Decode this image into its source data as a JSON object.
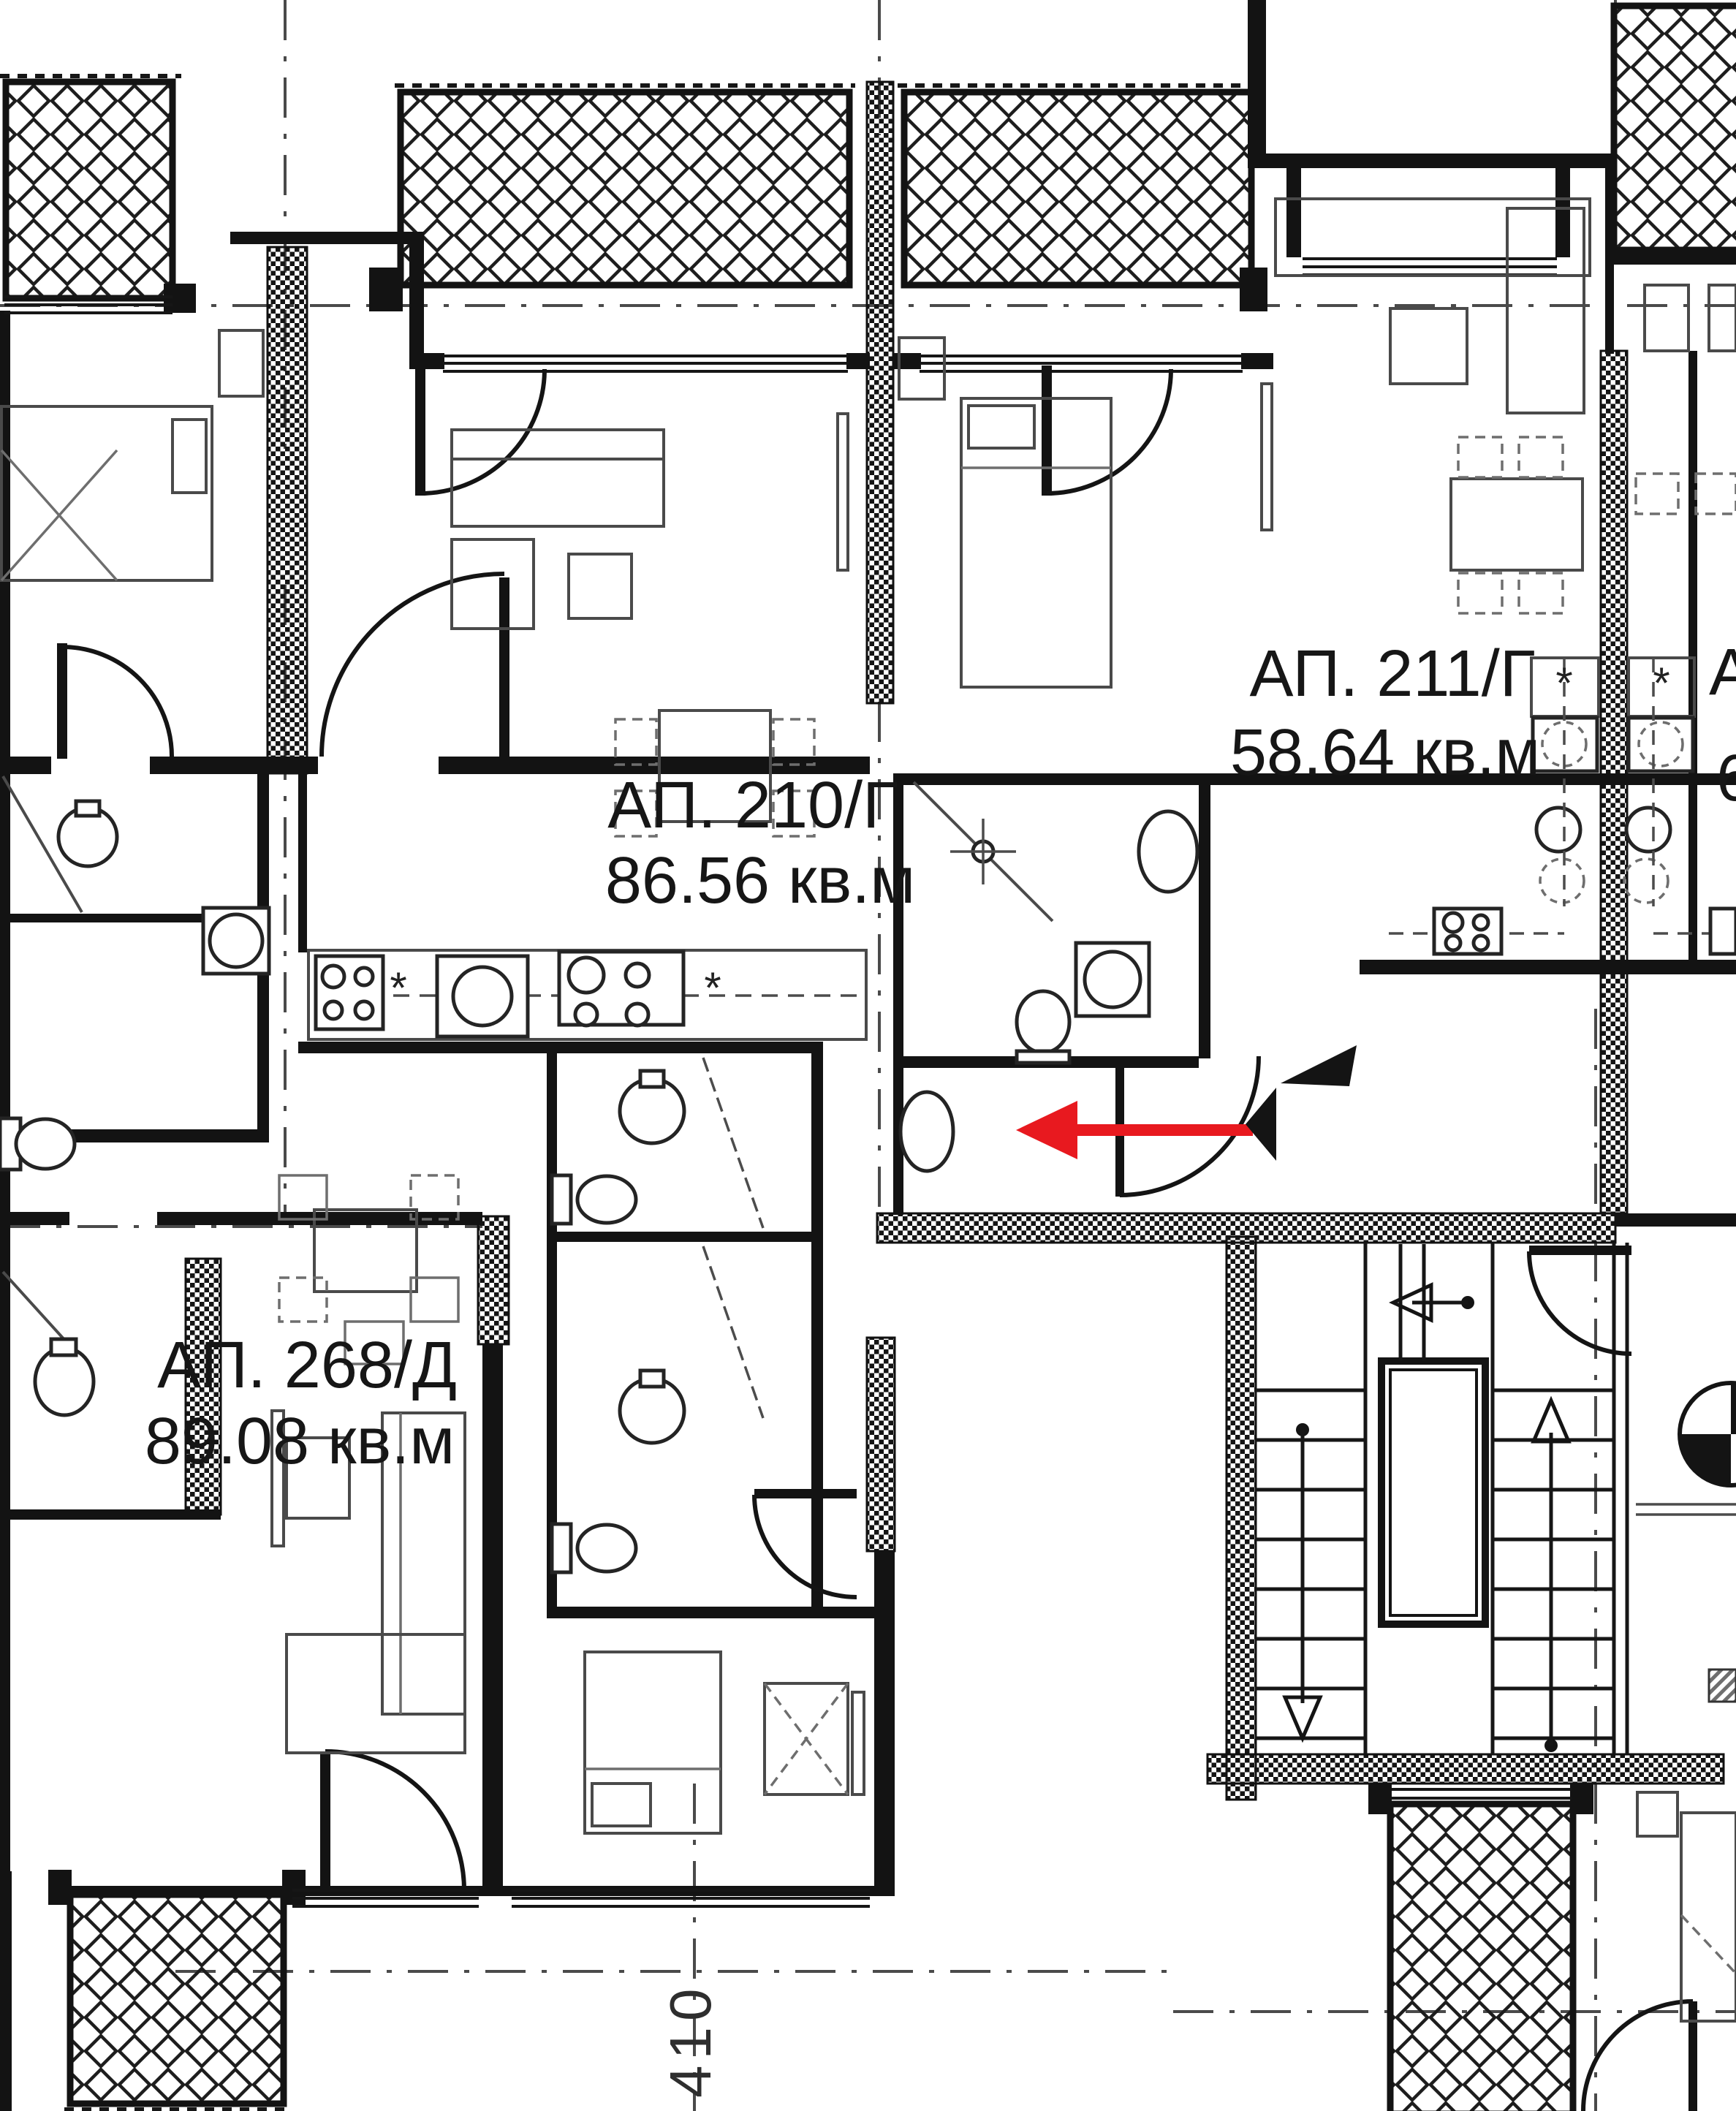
{
  "plan": {
    "apartments": [
      {
        "name": "АП. 210/Г",
        "area": "86.56 кв.м"
      },
      {
        "name": "АП. 211/Г",
        "area": "58.64 кв.м"
      },
      {
        "name": "АП. 268/Д",
        "area": "89.08 кв.м"
      }
    ],
    "partial_right_label": {
      "line1": "А",
      "line2": "6"
    },
    "dimension_marks": {
      "axis_410": "410"
    },
    "symbols": {
      "kitchen_star": "*"
    },
    "colors": {
      "paper": "#ffffff",
      "line": "#161616",
      "furniture": "#4a4a4a",
      "axis": "#4a4a4a",
      "entrance_arrow": "#e8191f"
    }
  }
}
